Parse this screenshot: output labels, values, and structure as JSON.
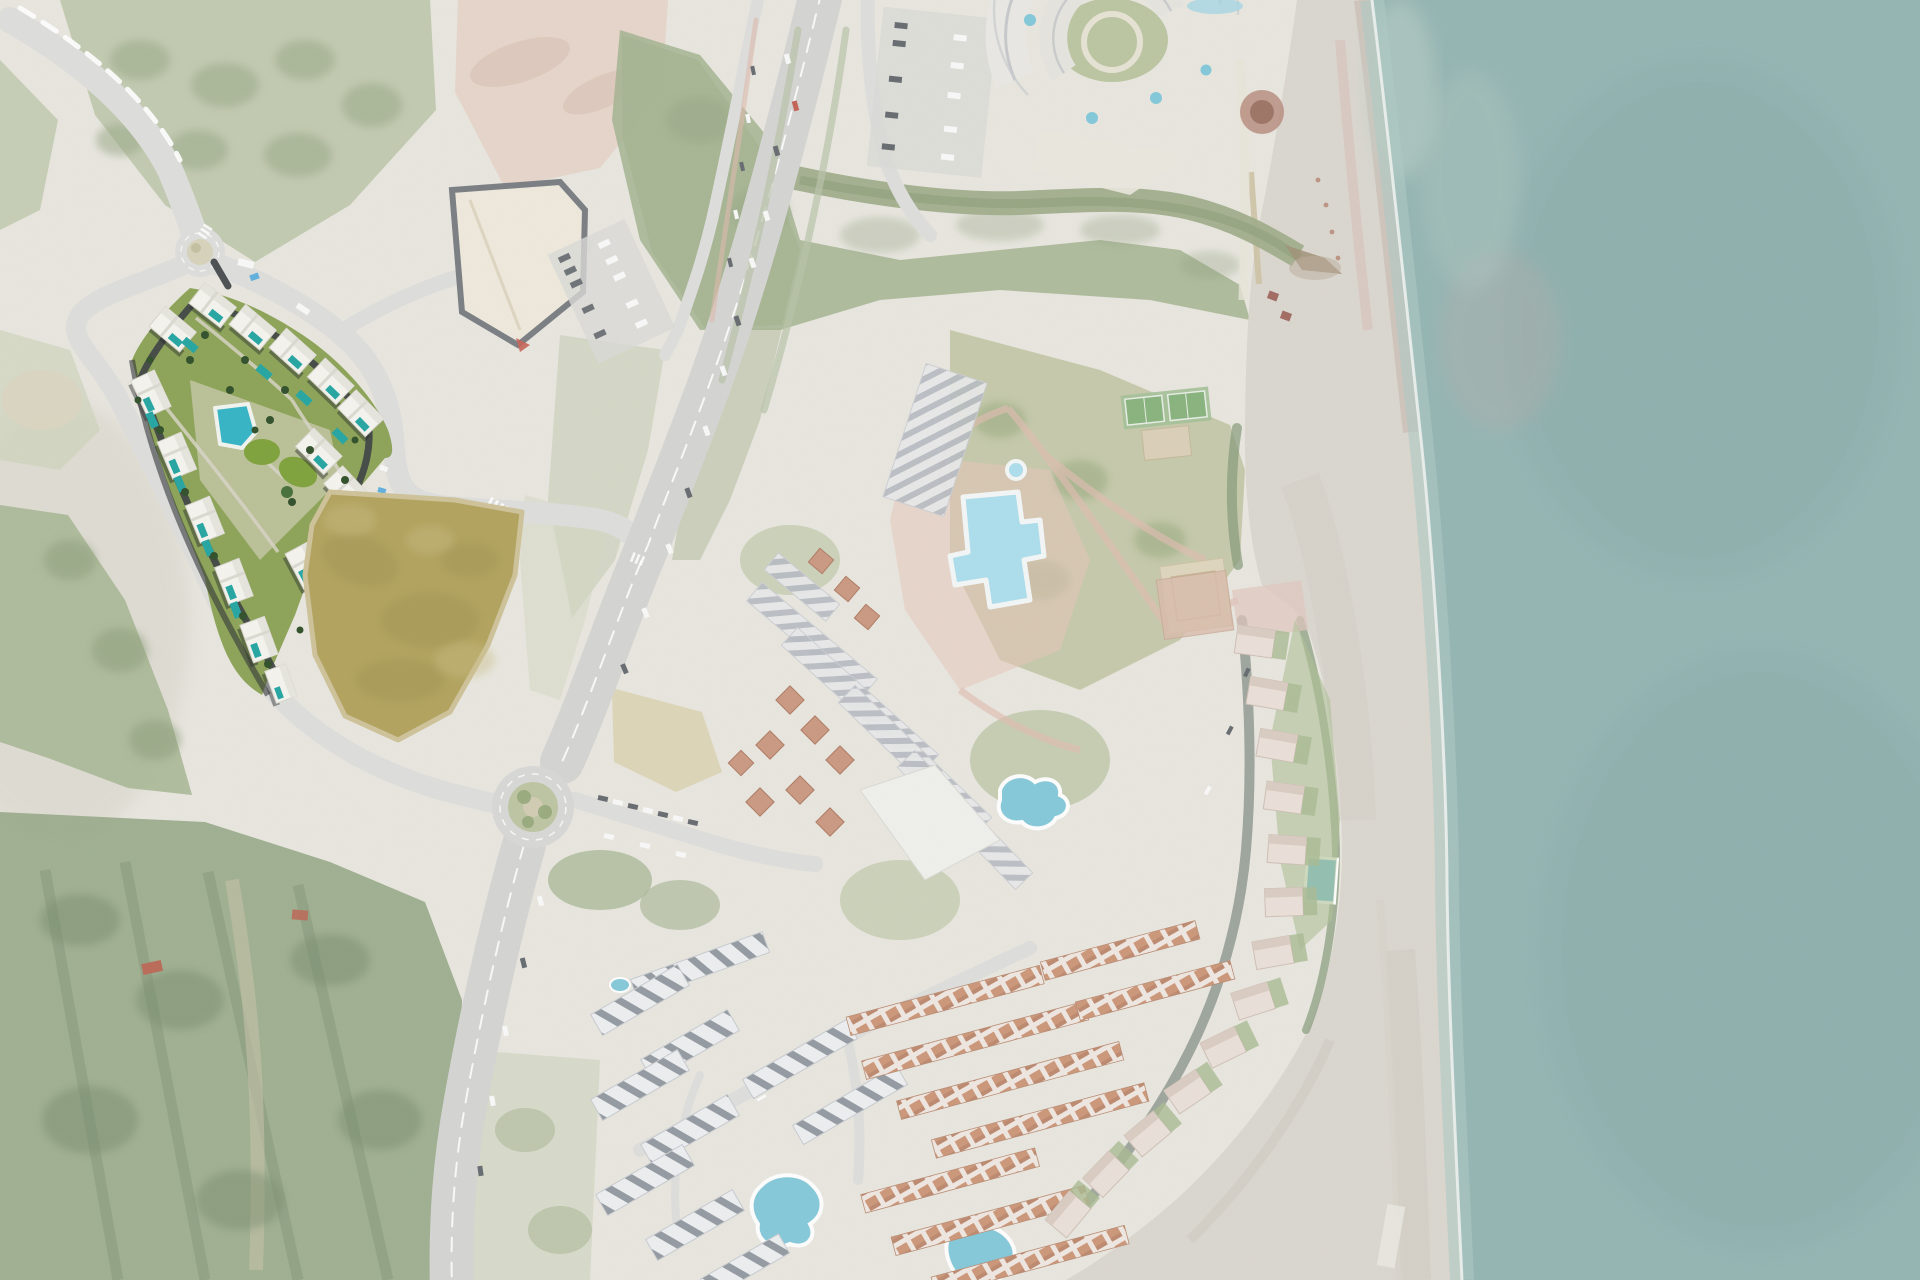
{
  "window": {
    "title": "Aerial satellite view — coastal resort area with highlighted development site"
  },
  "map": {
    "view": "top-down aerial photograph",
    "highlight": {
      "name": "development-site-render",
      "style": "full-color 3D masterplan render over faded satellite imagery",
      "elements": [
        "white apartment blocks",
        "rooftop and garden pools",
        "central swimming pool",
        "oval lawns",
        "palm trees",
        "internal asphalt loop road"
      ]
    },
    "features": [
      "sea",
      "beach",
      "surf-line",
      "river-channel",
      "river-mouth",
      "highway",
      "frontage-road",
      "roundabout-north",
      "roundabout-south",
      "top-left-access-road",
      "coastal-road",
      "neighborhood-streets",
      "supermarket-building",
      "supermarket-parking",
      "north-east-parking",
      "circular-resort-complex",
      "resort-courtyard",
      "resort-terrace-pools",
      "zigzag-apartment-rows",
      "large-resort-pool",
      "lagoon-pool",
      "terracotta-villa-cluster",
      "pink-plaza",
      "park-lawns",
      "park-paths",
      "tennis-courts",
      "padel-court",
      "sports-pad",
      "white-housing-blocks",
      "terracotta-housing-rows",
      "coastal-townhouse-strip",
      "strip-rectangular-pool",
      "kidney-pool",
      "south-pool",
      "small-neighborhood-pool",
      "vacant-olive-field",
      "forest-bottom-left",
      "orchard-rows",
      "west-canyon",
      "top-left-scrub-forest",
      "riverside-forest",
      "red-roof-shed",
      "beach-huts",
      "beach-groyne",
      "beach-bridge"
    ]
  },
  "palette": {
    "land": "#e8e6de",
    "sea": "#8cb0ae",
    "sea_deep": "#83a7a5",
    "shore": "#a9c6c0",
    "beach": "#d9d5cd",
    "beach_wet": "#c0aea4",
    "forest": "#90a37f",
    "forest_light": "#b3bf9e",
    "scrub": "#c3cbb0",
    "dry_grass": "#d8cfab",
    "dirt": "#e3cec0",
    "river": "#9aa883",
    "road": "#dcdcda",
    "highway": "#d2d2d0",
    "coastal_road": "#8e978e",
    "asphalt_dark": "#3c4043",
    "pool_big": "#a7dcec",
    "pool_small": "#7cc6d8",
    "dev_building": "#f6f5f0",
    "dev_pool": "#25a6a3",
    "dev_lawn": "#7fa33c",
    "dev_tree": "#31502a",
    "field_olive": "#b3a45e",
    "terracotta": "#c98f74",
    "tennis_green": "#7fae74",
    "plaza_pink": "#e6c3b6",
    "white_building": "#eceef0"
  }
}
